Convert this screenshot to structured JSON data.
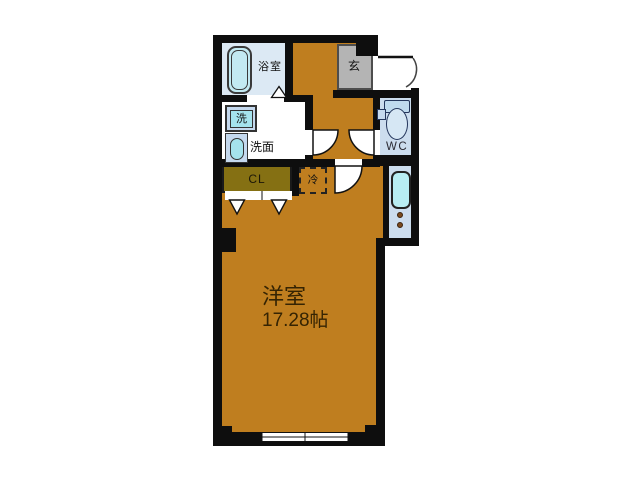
{
  "plan": {
    "rooms": {
      "bathroom": {
        "label": "浴室"
      },
      "washer": {
        "label": "洗"
      },
      "washroom": {
        "label": "洗面"
      },
      "entrance": {
        "label": "玄"
      },
      "wc": {
        "label": "WC"
      },
      "closet": {
        "label": "CL"
      },
      "fridge": {
        "label": "冷"
      },
      "main_room": {
        "label": "洋室",
        "size": "17.28帖"
      }
    },
    "colors": {
      "wall": "#0e0e0e",
      "room_fill": "#bf7e1f",
      "closet_fill": "#857013",
      "bath_fill": "#dce9f4",
      "water_fill": "#ccddee",
      "entrance_fill": "#b4b4b4",
      "fixture_cyan": "#a5e3ed",
      "fixture_blue": "#c5d9ee",
      "tub_fill": "#c3eaf2",
      "toilet_fill": "#d6e7f4",
      "tank_fill": "#bfdaee",
      "sink_fill": "#b8edf3",
      "burner": "#7b4a1d",
      "text": "#111111",
      "main_text": "#352403"
    }
  }
}
